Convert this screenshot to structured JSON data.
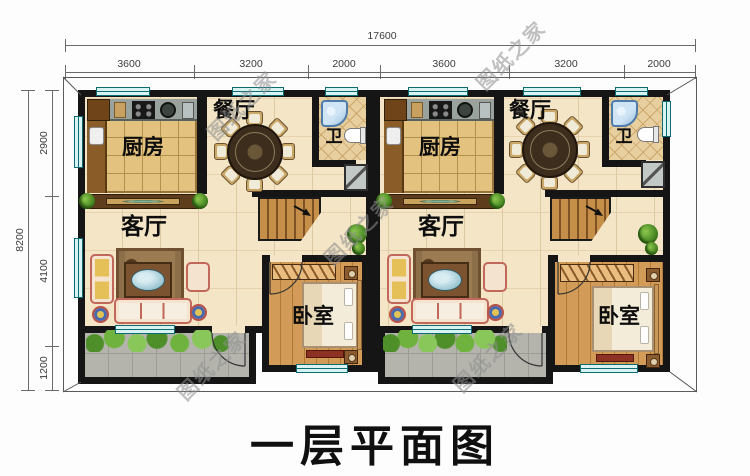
{
  "title": "一层平面图",
  "watermark": "图纸之家",
  "dims": {
    "top_total": "17600",
    "top_segments": [
      "3600",
      "3200",
      "2000",
      "3600",
      "3200",
      "2000"
    ],
    "left_total": "8200",
    "left_segments": [
      "2900",
      "4100",
      "1200"
    ]
  },
  "units": [
    {
      "kitchen": "厨房",
      "dining": "餐厅",
      "bath": "卫",
      "living": "客厅",
      "bedroom": "卧室"
    },
    {
      "kitchen": "厨房",
      "dining": "餐厅",
      "bath": "卫",
      "living": "客厅",
      "bedroom": "卧室"
    }
  ]
}
